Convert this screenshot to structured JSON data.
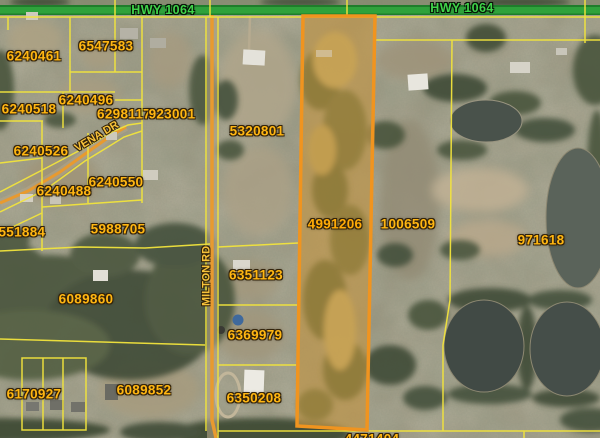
{
  "map": {
    "type": "aerial-parcel-map",
    "roads": {
      "highway": {
        "label": "HWY 1064"
      },
      "milton": {
        "label": "MILTON RD"
      },
      "vena": {
        "label": "VENA DR"
      }
    },
    "selected_parcel_id": "4991206",
    "parcels": [
      {
        "id": "6240461"
      },
      {
        "id": "6547583"
      },
      {
        "id": "6240518"
      },
      {
        "id": "6240496"
      },
      {
        "id": "6298117"
      },
      {
        "id": "923001"
      },
      {
        "id": "5320801"
      },
      {
        "id": "6240526"
      },
      {
        "id": "6240550"
      },
      {
        "id": "6240488"
      },
      {
        "id": "6551884",
        "note": "partially cut at left edge"
      },
      {
        "id": "5988705"
      },
      {
        "id": "6089860"
      },
      {
        "id": "6351123"
      },
      {
        "id": "6369979"
      },
      {
        "id": "6170927"
      },
      {
        "id": "6089852"
      },
      {
        "id": "6350208"
      },
      {
        "id": "4991206",
        "selected": true
      },
      {
        "id": "1006509"
      },
      {
        "id": "971618"
      },
      {
        "id": "4471404",
        "note": "partially cut at bottom edge"
      }
    ],
    "colors": {
      "parcel_line": "#F2E43C",
      "parcel_label": "#FFB612",
      "selected_parcel_outline": "#F0941F",
      "selected_parcel_fill_tint": "#E6A32D",
      "highway_road": "#2FA23B",
      "highway_label": "#3FD449",
      "minor_road_line": "#E89A2F",
      "pond_water": "#4A524B"
    }
  }
}
